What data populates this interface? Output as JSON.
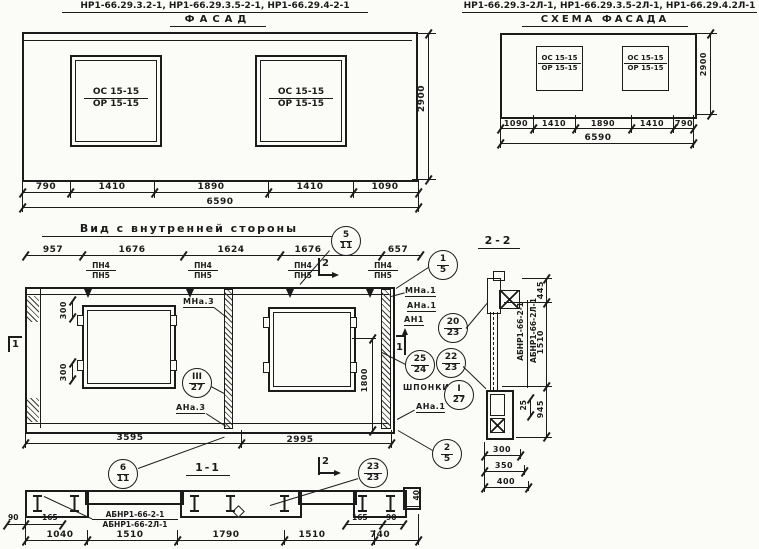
{
  "facade_left": {
    "title": "НР1-66.29.3.2-1, НР1-66.29.3.5-2-1, НР1-66.29.4-2-1",
    "subtitle": "ФАСАД",
    "window_top": "ОС 15-15",
    "window_bottom": "ОР 15-15",
    "dims": [
      "790",
      "1410",
      "1890",
      "1410",
      "1090"
    ],
    "total": "6590",
    "height": "2900"
  },
  "facade_right": {
    "title": "НР1-66.29.3-2Л-1, НР1-66.29.3.5-2Л-1, НР1-66.29.4.2Л-1",
    "subtitle": "СХЕМА ФАСАДА",
    "window_top": "ОС 15-15",
    "window_bottom": "ОР 15-15",
    "dims": [
      "1090",
      "1410",
      "1890",
      "1410",
      "790"
    ],
    "total": "6590",
    "height": "2900"
  },
  "inner": {
    "title": "Вид с внутренней стороны",
    "dims_top": [
      "957",
      "1676",
      "1624",
      "1676",
      "657"
    ],
    "pn_top": "ПН4",
    "pn_bottom": "ПН5",
    "dim300": "300",
    "dim1800": "1800",
    "mna3": "МНа.3",
    "ana3": "АНа.3",
    "mna1": "МНа.1",
    "ana1": "АНа.1",
    "an1": "АН1",
    "shponki": "ШПОНКИ",
    "ana1_low": "АНа.1",
    "dims_bottom": [
      "3595",
      "2995"
    ],
    "section1_label": "1-1"
  },
  "section2": {
    "title": "2-2",
    "label_a": "АБНР1-66-2-1",
    "label_b": "АБНР1-66-2Л-1",
    "dim_445": "445",
    "dim_1510": "1510",
    "dim_945": "945",
    "dim_25": "25",
    "dims_bottom": [
      "300",
      "350",
      "400"
    ]
  },
  "section1": {
    "label_a": "АБНР1-66-2-1",
    "label_b": "АБНР1-66-2Л-1",
    "dims": [
      "1040",
      "1510",
      "1790",
      "1510",
      "740"
    ],
    "dim_90l": "90",
    "dim_165l": "165",
    "dim_165r": "165",
    "dim_90r": "90",
    "dim_40": "40"
  },
  "callouts": {
    "c5_11": {
      "top": "5",
      "bottom": "11"
    },
    "c1_5": {
      "top": "1",
      "bottom": "5"
    },
    "c20_23": {
      "top": "20",
      "bottom": "23"
    },
    "c25_24": {
      "top": "25",
      "bottom": "24"
    },
    "c22_23": {
      "top": "22",
      "bottom": "23"
    },
    "cI_27": {
      "top": "I",
      "bottom": "27"
    },
    "cIII_27": {
      "top": "III",
      "bottom": "27"
    },
    "c2_5": {
      "top": "2",
      "bottom": "5"
    },
    "c6_11": {
      "top": "6",
      "bottom": "11"
    },
    "c23_23": {
      "top": "23",
      "bottom": "23"
    }
  },
  "flags": {
    "one": "1",
    "two": "2"
  }
}
